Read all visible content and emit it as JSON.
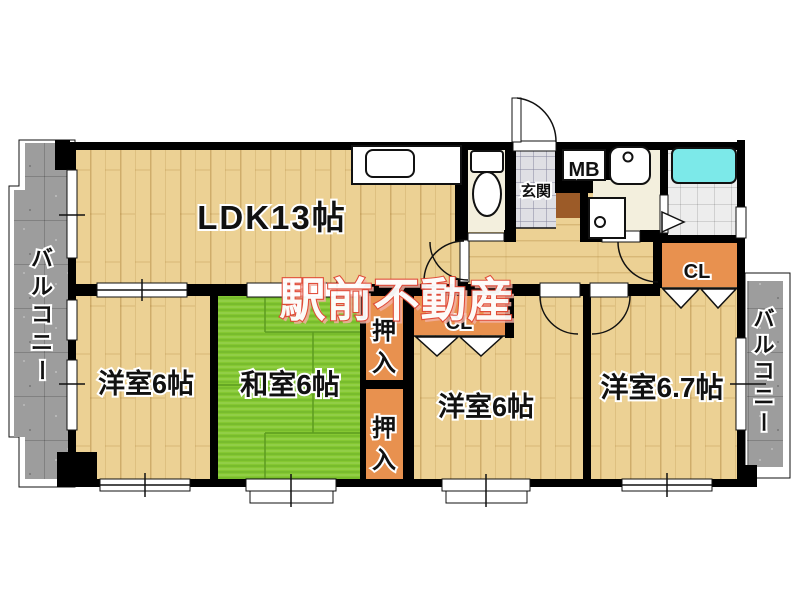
{
  "watermark": {
    "text": "駅前不動産",
    "fill": "#ffffff",
    "outline": "#e04835"
  },
  "rooms": {
    "ldk": {
      "label": "LDK13帖"
    },
    "bed_left": {
      "label": "洋室6帖"
    },
    "washitsu": {
      "label": "和室6帖"
    },
    "bed_center": {
      "label": "洋室6帖"
    },
    "bed_right": {
      "label": "洋室6.7帖"
    },
    "entrance": {
      "label": "玄関"
    },
    "meter_box": {
      "label": "MB"
    },
    "closet_center": {
      "label": "CL"
    },
    "closet_right": {
      "label": "CL"
    },
    "oshiire_upper": {
      "chars": [
        "押",
        "入"
      ]
    },
    "oshiire_lower": {
      "chars": [
        "押",
        "入"
      ]
    },
    "balcony_left": {
      "chars": [
        "バ",
        "ル",
        "コ",
        "ニ",
        "ー"
      ]
    },
    "balcony_right": {
      "chars": [
        "バ",
        "ル",
        "コ",
        "ニ",
        "ー"
      ]
    }
  },
  "colors": {
    "wall": "#000000",
    "wood": "#ecd194",
    "tatami": "#85c832",
    "closet_orange": "#e8914f",
    "balcony_gray": "#9d9d9d",
    "genkan_tile": "#dfdfe4",
    "bath_tile": "#ededed",
    "room_cream": "#f3efdd",
    "bathtub_cyan": "#7ce9e9",
    "step_brown": "#9c5b28",
    "label_text": "#111111",
    "watermark_fill": "#ffffff",
    "watermark_outline": "#e04835"
  }
}
